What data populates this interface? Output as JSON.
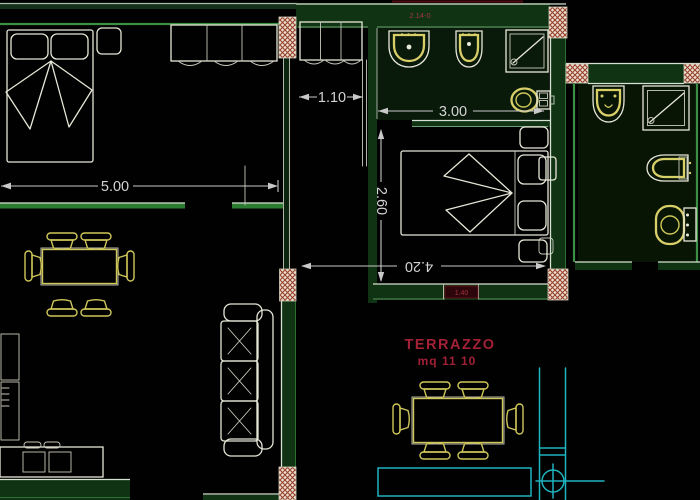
{
  "drawing": {
    "kind": "cad-floor-plan",
    "background": "#000000"
  },
  "dims": {
    "bedroom1": "5.00",
    "hallway": "1.10",
    "bathroom": "3.00",
    "bedroom2_depth": "2.60",
    "bedroom2_width": "4.20"
  },
  "terrace": {
    "name": "TERRAZZO",
    "area": "mq 11 10"
  },
  "tags": {
    "top_wall": "2.14-0",
    "window": "1.40"
  },
  "colors": {
    "wall_fill": "#113315",
    "wall_edge_light": "#d6e2d2",
    "wall_edge_green": "#3f8f46",
    "furniture_white": "#e7e7d9",
    "furniture_yellow": "#d8cf6e",
    "dimension": "#c9c9c9",
    "terrace_cyan": "#25b2bd",
    "label_red": "#9e2236",
    "column_hatch_red": "#96402e"
  },
  "symbols": [
    {
      "icon": "double-bed-icon",
      "room": "bedroom-1"
    },
    {
      "icon": "nightstand-icon",
      "room": "bedroom-1"
    },
    {
      "icon": "wardrobe-icon",
      "room": "bedroom-1"
    },
    {
      "icon": "closet-icon",
      "room": "hallway"
    },
    {
      "icon": "sink-icon",
      "room": "bathroom-1"
    },
    {
      "icon": "bidet-icon",
      "room": "bathroom-1"
    },
    {
      "icon": "shower-icon",
      "room": "bathroom-1"
    },
    {
      "icon": "toilet-icon",
      "room": "bathroom-1"
    },
    {
      "icon": "double-bed-icon",
      "room": "bedroom-2"
    },
    {
      "icon": "nightstand-icon",
      "room": "bedroom-2"
    },
    {
      "icon": "sink-icon",
      "room": "bathroom-2"
    },
    {
      "icon": "shower-icon",
      "room": "bathroom-2"
    },
    {
      "icon": "bidet-icon",
      "room": "bathroom-2"
    },
    {
      "icon": "toilet-icon",
      "room": "bathroom-2"
    },
    {
      "icon": "dining-table-icon",
      "room": "living-room"
    },
    {
      "icon": "sofa-icon",
      "room": "living-room"
    },
    {
      "icon": "tv-cabinet-icon",
      "room": "living-room"
    },
    {
      "icon": "dining-table-icon",
      "room": "terrace"
    },
    {
      "icon": "drain-crosshair-icon",
      "room": "terrace"
    },
    {
      "icon": "column-hatch",
      "room": "structure"
    }
  ]
}
